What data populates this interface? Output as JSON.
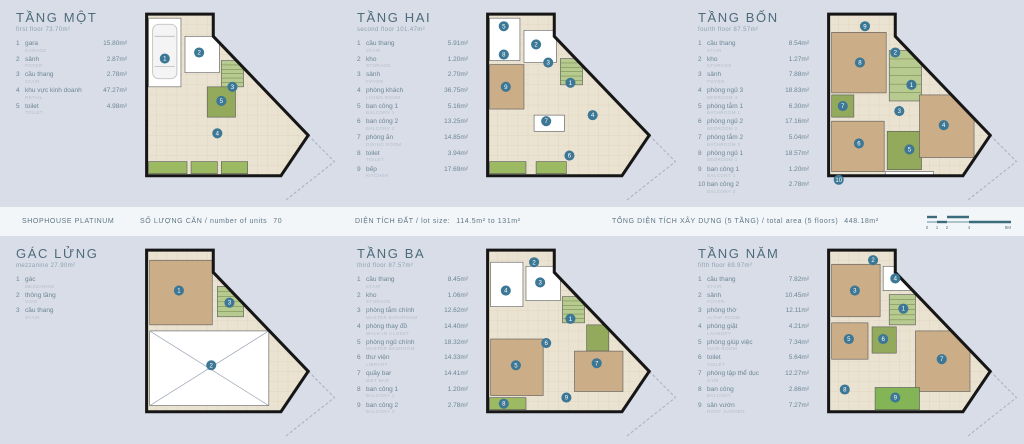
{
  "page": {
    "background": "#d8dde8"
  },
  "band": {
    "brand": "SHOPHOUSE PLATINUM",
    "units_label": "SỐ LƯỢNG CĂN / number of units",
    "units_value": "70",
    "lot_label": "DIỆN TÍCH ĐẤT / lot size:",
    "lot_value": "114.5m² to 131m²",
    "total_label": "TỔNG DIỆN TÍCH XÂY DỰNG  (5 TẦNG) / total area (5 floors)",
    "total_value": "448.18m²",
    "scale_labels": [
      "0",
      "1",
      "2",
      "4",
      "8M"
    ]
  },
  "plan_colors": {
    "base": "#ebe3d2",
    "grid": "#ddd2ba",
    "wall": "#161616",
    "white": "#ffffff",
    "tan": "#cbad87",
    "green_light": "#b7ca90",
    "green_dark": "#93a95c",
    "planter": "#9cba62",
    "garden": "#83b455",
    "marker": "#3c7795",
    "lot_line": "#a7b2c0",
    "scale": "#3c6b7d"
  },
  "floors": [
    {
      "id": "tang-mot",
      "title": "TẦNG MỘT",
      "subtitle": "first floor 73.70m²",
      "items": [
        {
          "n": "1",
          "name": "gara",
          "sub": "GARAGE",
          "area": "15.80m²"
        },
        {
          "n": "2",
          "name": "sảnh",
          "sub": "FOYER",
          "area": "2.87m²"
        },
        {
          "n": "3",
          "name": "cầu thang",
          "sub": "STAIR",
          "area": "2.78m²"
        },
        {
          "n": "4",
          "name": "khu vực kinh doanh",
          "sub": "RETAIL",
          "area": "47.27m²"
        },
        {
          "n": "5",
          "name": "toilet",
          "sub": "TOILET",
          "area": "4.98m²"
        }
      ],
      "plan": {
        "outline": "14,12 80,12 80,34 174,132 147,172 14,172",
        "lotline": "174,132 200,158 152,196",
        "rooms": [
          [
            16,
            16,
            32,
            68,
            "white"
          ],
          [
            52,
            34,
            34,
            36,
            "white"
          ],
          [
            88,
            58,
            22,
            26,
            "green_light",
            "h"
          ],
          [
            74,
            84,
            28,
            30,
            "green_dark"
          ],
          [
            16,
            158,
            38,
            12,
            "planter"
          ],
          [
            58,
            158,
            26,
            12,
            "planter"
          ],
          [
            88,
            158,
            26,
            12,
            "planter"
          ]
        ],
        "car": [
          20,
          22,
          24,
          54
        ],
        "markers": [
          [
            1,
            32,
            56
          ],
          [
            2,
            66,
            50
          ],
          [
            3,
            99,
            84
          ],
          [
            5,
            88,
            98
          ],
          [
            4,
            84,
            130
          ]
        ]
      }
    },
    {
      "id": "tang-hai",
      "title": "TẦNG HAI",
      "subtitle": "second floor 101.47m²",
      "items": [
        {
          "n": "1",
          "name": "cầu thang",
          "sub": "STAIR",
          "area": "5.91m²"
        },
        {
          "n": "2",
          "name": "kho",
          "sub": "STORAGE",
          "area": "1.20m²"
        },
        {
          "n": "3",
          "name": "sảnh",
          "sub": "FOYER",
          "area": "2.70m²"
        },
        {
          "n": "4",
          "name": "phòng khách",
          "sub": "LIVING ROOM",
          "area": "36.75m²"
        },
        {
          "n": "5",
          "name": "ban công 1",
          "sub": "BALCONY 1",
          "area": "5.16m²"
        },
        {
          "n": "6",
          "name": "ban công 2",
          "sub": "BALCONY 2",
          "area": "13.25m²"
        },
        {
          "n": "7",
          "name": "phòng ăn",
          "sub": "DINING ROOM",
          "area": "14.85m²"
        },
        {
          "n": "8",
          "name": "toilet",
          "sub": "TOILET",
          "area": "3.94m²"
        },
        {
          "n": "9",
          "name": "bếp",
          "sub": "KITCHEN",
          "area": "17.69m²"
        }
      ],
      "plan": {
        "outline": "14,12 80,12 80,34 174,132 147,172 14,172",
        "lotline": "174,132 200,158 152,196",
        "rooms": [
          [
            16,
            16,
            30,
            42,
            "white"
          ],
          [
            50,
            28,
            32,
            32,
            "white"
          ],
          [
            86,
            56,
            22,
            26,
            "green_light",
            "h"
          ],
          [
            16,
            62,
            34,
            44,
            "tan"
          ],
          [
            60,
            112,
            30,
            16,
            "white"
          ],
          [
            16,
            158,
            36,
            12,
            "planter"
          ],
          [
            62,
            158,
            30,
            12,
            "planter"
          ]
        ],
        "markers": [
          [
            5,
            30,
            24
          ],
          [
            2,
            62,
            42
          ],
          [
            3,
            74,
            60
          ],
          [
            1,
            96,
            80
          ],
          [
            8,
            30,
            52
          ],
          [
            9,
            32,
            84
          ],
          [
            7,
            72,
            118
          ],
          [
            4,
            118,
            112
          ],
          [
            6,
            95,
            152
          ]
        ]
      }
    },
    {
      "id": "tang-bon",
      "title": "TẦNG BỐN",
      "subtitle": "fourth floor 87.57m²",
      "items": [
        {
          "n": "1",
          "name": "cầu thang",
          "sub": "STAIR",
          "area": "8.54m²"
        },
        {
          "n": "2",
          "name": "kho",
          "sub": "STORAGE",
          "area": "1.27m²"
        },
        {
          "n": "3",
          "name": "sảnh",
          "sub": "FOYER",
          "area": "7.88m²"
        },
        {
          "n": "4",
          "name": "phòng ngủ 3",
          "sub": "BEDROOM 3",
          "area": "18.83m²"
        },
        {
          "n": "5",
          "name": "phòng tắm 1",
          "sub": "BATHROOM 1",
          "area": "6.30m²"
        },
        {
          "n": "6",
          "name": "phòng ngủ 2",
          "sub": "BEDROOM 2",
          "area": "17.16m²"
        },
        {
          "n": "7",
          "name": "phòng tắm 2",
          "sub": "BATHROOM 2",
          "area": "5.04m²"
        },
        {
          "n": "8",
          "name": "phòng ngủ 1",
          "sub": "BEDROOM 1",
          "area": "18.57m²"
        },
        {
          "n": "9",
          "name": "ban công 1",
          "sub": "BALCONY 1",
          "area": "1.20m²"
        },
        {
          "n": "10",
          "name": "ban công 2",
          "sub": "BALCONY 2",
          "area": "2.78m²"
        }
      ],
      "plan": {
        "outline": "14,12 80,12 80,34 174,132 147,172 14,172",
        "lotline": "174,132 200,158 152,196",
        "rooms": [
          [
            17,
            30,
            54,
            60,
            "tan"
          ],
          [
            74,
            48,
            32,
            50,
            "green_light",
            "h"
          ],
          [
            17,
            92,
            22,
            22,
            "green_dark"
          ],
          [
            17,
            118,
            52,
            50,
            "tan"
          ],
          [
            72,
            128,
            34,
            38,
            "green_dark"
          ],
          [
            104,
            92,
            54,
            62,
            "tan"
          ],
          [
            70,
            168,
            48,
            12,
            "white"
          ]
        ],
        "markers": [
          [
            9,
            50,
            24
          ],
          [
            2,
            80,
            50
          ],
          [
            8,
            45,
            60
          ],
          [
            1,
            96,
            82
          ],
          [
            7,
            28,
            103
          ],
          [
            3,
            84,
            108
          ],
          [
            4,
            128,
            122
          ],
          [
            6,
            44,
            140
          ],
          [
            5,
            94,
            146
          ],
          [
            10,
            24,
            176
          ]
        ]
      }
    },
    {
      "id": "gac-lung",
      "title": "GÁC LỬNG",
      "subtitle": "mezzanine 27.90m²",
      "items": [
        {
          "n": "1",
          "name": "gác",
          "sub": "MEZZANINE",
          "area": ""
        },
        {
          "n": "2",
          "name": "thông tầng",
          "sub": "VOID",
          "area": ""
        },
        {
          "n": "3",
          "name": "cầu thang",
          "sub": "STAIR",
          "area": ""
        }
      ],
      "plan": {
        "outline": "14,12 80,12 80,34 174,132 147,172 14,172",
        "lotline": "174,132 200,158 152,196",
        "rooms": [
          [
            17,
            22,
            62,
            64,
            "tan"
          ],
          [
            84,
            48,
            26,
            30,
            "green_light",
            "h"
          ],
          [
            17,
            92,
            118,
            74,
            "white",
            "x"
          ]
        ],
        "markers": [
          [
            1,
            46,
            52
          ],
          [
            3,
            96,
            64
          ],
          [
            2,
            78,
            126
          ]
        ]
      }
    },
    {
      "id": "tang-ba",
      "title": "TẦNG BA",
      "subtitle": "third floor 87.57m²",
      "items": [
        {
          "n": "1",
          "name": "cầu thang",
          "sub": "STAIR",
          "area": "8.45m²"
        },
        {
          "n": "2",
          "name": "kho",
          "sub": "STORAGE",
          "area": "1.06m²"
        },
        {
          "n": "3",
          "name": "phòng tắm chính",
          "sub": "MASTER BATHROOM",
          "area": "12.62m²"
        },
        {
          "n": "4",
          "name": "phòng thay đồ",
          "sub": "WALK-IN CLOSET",
          "area": "14.40m²"
        },
        {
          "n": "5",
          "name": "phòng ngủ chính",
          "sub": "MASTER BEDROOM",
          "area": "18.32m²"
        },
        {
          "n": "6",
          "name": "thư viện",
          "sub": "LIBRARY",
          "area": "14.33m²"
        },
        {
          "n": "7",
          "name": "quầy bar",
          "sub": "WET BAR",
          "area": "14.41m²"
        },
        {
          "n": "8",
          "name": "ban công 1",
          "sub": "BALCONY 1",
          "area": "1.20m²"
        },
        {
          "n": "9",
          "name": "ban công 2",
          "sub": "BALCONY 2",
          "area": "2.78m²"
        }
      ],
      "plan": {
        "outline": "14,12 80,12 80,34 174,132 147,172 14,172",
        "lotline": "174,132 200,158 152,196",
        "rooms": [
          [
            17,
            24,
            32,
            44,
            "white"
          ],
          [
            52,
            28,
            34,
            34,
            "white"
          ],
          [
            88,
            58,
            22,
            26,
            "green_light",
            "h"
          ],
          [
            17,
            100,
            52,
            56,
            "tan"
          ],
          [
            112,
            86,
            22,
            26,
            "green_dark"
          ],
          [
            100,
            112,
            48,
            40,
            "tan"
          ],
          [
            16,
            158,
            36,
            12,
            "planter"
          ]
        ],
        "markers": [
          [
            2,
            60,
            24
          ],
          [
            3,
            66,
            44
          ],
          [
            4,
            32,
            52
          ],
          [
            1,
            96,
            80
          ],
          [
            6,
            72,
            104
          ],
          [
            7,
            122,
            124
          ],
          [
            5,
            42,
            126
          ],
          [
            8,
            30,
            164
          ],
          [
            9,
            92,
            158
          ]
        ]
      }
    },
    {
      "id": "tang-nam",
      "title": "TẦNG NĂM",
      "subtitle": "fifth floor 69.97m²",
      "items": [
        {
          "n": "1",
          "name": "cầu thang",
          "sub": "STAIR",
          "area": "7.82m²"
        },
        {
          "n": "2",
          "name": "sảnh",
          "sub": "FOYER",
          "area": "10.45m²"
        },
        {
          "n": "3",
          "name": "phòng thờ",
          "sub": "ALTAR ROOM",
          "area": "12.11m²"
        },
        {
          "n": "4",
          "name": "phòng giặt",
          "sub": "LAUNDRY",
          "area": "4.21m²"
        },
        {
          "n": "5",
          "name": "phòng giúp việc",
          "sub": "MAID ROOM",
          "area": "7.34m²"
        },
        {
          "n": "6",
          "name": "toilet",
          "sub": "TOILET",
          "area": "5.64m²"
        },
        {
          "n": "7",
          "name": "phòng tập thể dục",
          "sub": "GYM",
          "area": "12.27m²"
        },
        {
          "n": "8",
          "name": "ban công",
          "sub": "BALCONY",
          "area": "2.86m²"
        },
        {
          "n": "9",
          "name": "sân vườn",
          "sub": "ROOF GARDEN",
          "area": "7.27m²"
        }
      ],
      "plan": {
        "outline": "14,12 80,12 80,34 174,132 147,172 14,172",
        "lotline": "174,132 200,158 152,196",
        "rooms": [
          [
            17,
            26,
            48,
            52,
            "tan"
          ],
          [
            68,
            28,
            28,
            24,
            "white"
          ],
          [
            74,
            56,
            26,
            30,
            "green_light",
            "h"
          ],
          [
            17,
            84,
            36,
            36,
            "tan"
          ],
          [
            57,
            88,
            24,
            26,
            "green_dark"
          ],
          [
            100,
            92,
            54,
            60,
            "tan"
          ],
          [
            60,
            148,
            44,
            22,
            "garden"
          ]
        ],
        "markers": [
          [
            3,
            40,
            52
          ],
          [
            4,
            80,
            40
          ],
          [
            1,
            88,
            70
          ],
          [
            2,
            58,
            22
          ],
          [
            5,
            34,
            100
          ],
          [
            6,
            68,
            100
          ],
          [
            7,
            126,
            120
          ],
          [
            8,
            30,
            150
          ],
          [
            9,
            80,
            158
          ]
        ]
      }
    }
  ]
}
